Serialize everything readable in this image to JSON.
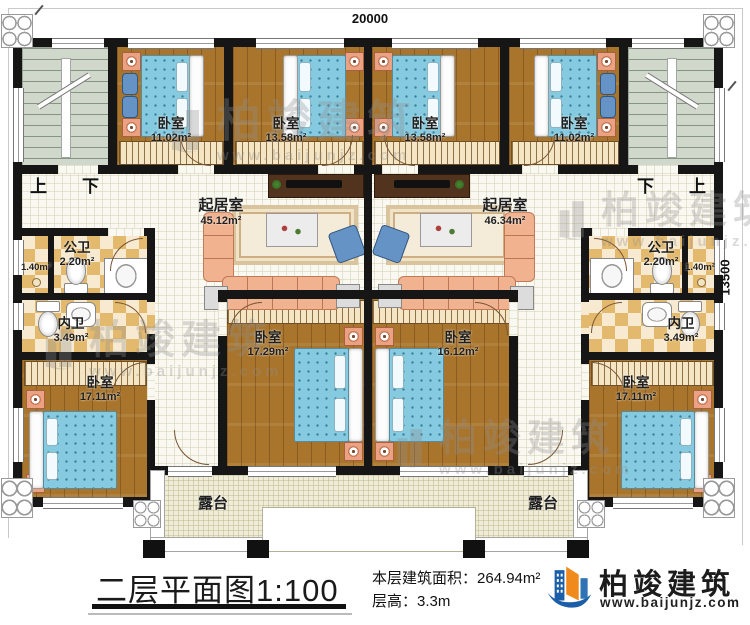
{
  "plan": {
    "dim_width": "20000",
    "dim_height": "13500",
    "stair_left": {
      "up": "上",
      "down": "下"
    },
    "stair_right": {
      "down": "下",
      "up": "上"
    },
    "rooms": {
      "bedroom_top_a": {
        "name": "卧室",
        "area": "11.02m²"
      },
      "bedroom_top_b": {
        "name": "卧室",
        "area": "13.58m²"
      },
      "bedroom_top_c": {
        "name": "卧室",
        "area": "13.58m²"
      },
      "bedroom_top_d": {
        "name": "卧室",
        "area": "11.02m²"
      },
      "living_left": {
        "name": "起居室",
        "area": "45.12m²"
      },
      "living_right": {
        "name": "起居室",
        "area": "46.34m²"
      },
      "public_bath_left": {
        "name": "公卫",
        "area": "2.20m²"
      },
      "public_bath_right": {
        "name": "公卫",
        "area": "2.20m²"
      },
      "closet_left": {
        "area": "1.40m²"
      },
      "closet_right": {
        "area": "1.40m²"
      },
      "inner_bath_left": {
        "name": "内卫",
        "area": "3.49m²"
      },
      "inner_bath_right": {
        "name": "内卫",
        "area": "3.49m²"
      },
      "bedroom_mid_left": {
        "name": "卧室",
        "area": "17.29m²"
      },
      "bedroom_mid_right": {
        "name": "卧室",
        "area": "16.12m²"
      },
      "bedroom_bottom_left": {
        "name": "卧室",
        "area": "17.11m²"
      },
      "bedroom_bottom_right": {
        "name": "卧室",
        "area": "17.11m²"
      },
      "terrace_left": {
        "name": "露台"
      },
      "terrace_right": {
        "name": "露台"
      }
    }
  },
  "footer": {
    "title": "二层平面图",
    "scale": "1:100",
    "area_label": "本层建筑面积：",
    "area_value": "264.94m²",
    "floor_height_label": "层高：",
    "floor_height_value": "3.3m"
  },
  "brand": {
    "name": "柏竣建筑",
    "url": "www.baijunjz.com"
  }
}
